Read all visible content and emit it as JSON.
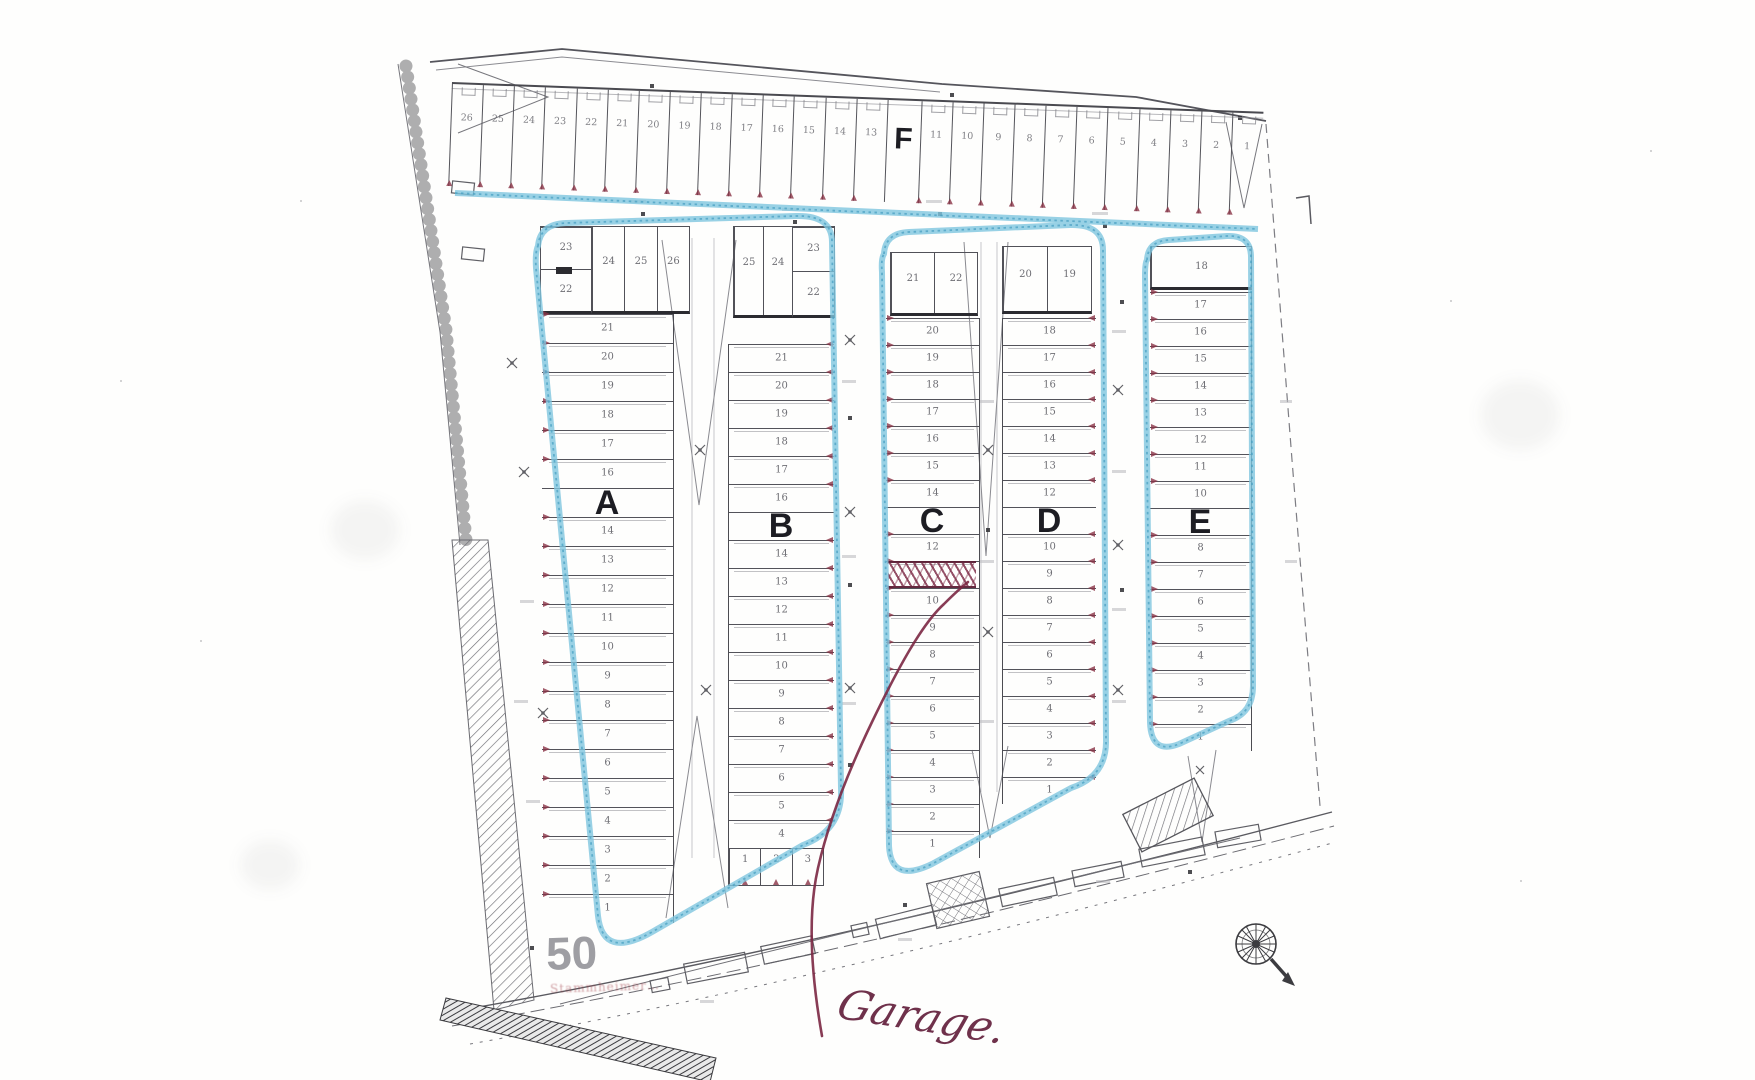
{
  "meta": {
    "document_kind": "scanned garage site plan",
    "colors": {
      "highlighter_blue": "#7fc6df",
      "annotation_red": "#7b2743",
      "hatch_red": "#8a3346",
      "ink": "#4a4a52",
      "label_ink": "#1d1d23",
      "house_number_gray": "#8e8e93",
      "paper": "#fefefd"
    }
  },
  "plan": {
    "row_f": {
      "label": "F",
      "stalls_before_label": [
        "26",
        "25",
        "24",
        "23",
        "22",
        "21",
        "20",
        "19",
        "18",
        "17",
        "16",
        "15",
        "14",
        "13"
      ],
      "stalls_after_label": [
        "11",
        "10",
        "9",
        "8",
        "7",
        "6",
        "5",
        "4",
        "3",
        "2",
        "1"
      ]
    },
    "block_a": {
      "label": "A",
      "corner_stack": [
        "23",
        "22"
      ],
      "top_stalls": [
        "24",
        "25",
        "26"
      ],
      "rows_above_label": [
        "21",
        "20",
        "19",
        "18",
        "17",
        "16"
      ],
      "rows_below_label": [
        "14",
        "13",
        "12",
        "11",
        "10",
        "9",
        "8",
        "7",
        "6",
        "5",
        "4",
        "3",
        "2",
        "1"
      ]
    },
    "block_b": {
      "label": "B",
      "top_stalls": [
        "25",
        "24"
      ],
      "corner_stack": [
        "23",
        "22"
      ],
      "rows_above_label": [
        "21",
        "20",
        "19",
        "18",
        "17",
        "16"
      ],
      "rows_below_label": [
        "14",
        "13",
        "12",
        "11",
        "10",
        "9",
        "8",
        "7",
        "6",
        "5",
        "4"
      ],
      "bottom_stalls": [
        "1",
        "2",
        "3"
      ]
    },
    "block_c": {
      "label": "C",
      "top_stalls": [
        "21",
        "22"
      ],
      "rows_above_label": [
        "20",
        "19",
        "18",
        "17",
        "16",
        "15",
        "14"
      ],
      "rows_below_label": [
        "12",
        "",
        "10",
        "9",
        "8",
        "7",
        "6",
        "5",
        "4",
        "3",
        "2",
        "1"
      ],
      "marked_stall": "hatched stall between 12 and 10"
    },
    "block_d": {
      "label": "D",
      "top_stalls": [
        "20",
        "19"
      ],
      "rows_above_label": [
        "18",
        "17",
        "16",
        "15",
        "14",
        "13",
        "12"
      ],
      "rows_below_label": [
        "10",
        "9",
        "8",
        "7",
        "6",
        "5",
        "4",
        "3",
        "2",
        "1"
      ]
    },
    "block_e": {
      "label": "E",
      "top_stalls": [
        "18"
      ],
      "rows_above_label": [
        "17",
        "16",
        "15",
        "14",
        "13",
        "12",
        "11",
        "10"
      ],
      "rows_below_label": [
        "8",
        "7",
        "6",
        "5",
        "4",
        "3",
        "2",
        "1"
      ]
    },
    "annotations": {
      "handwritten_note": "Garage.",
      "house_number": "50",
      "street_name_faint": "Stammheimer…"
    }
  }
}
